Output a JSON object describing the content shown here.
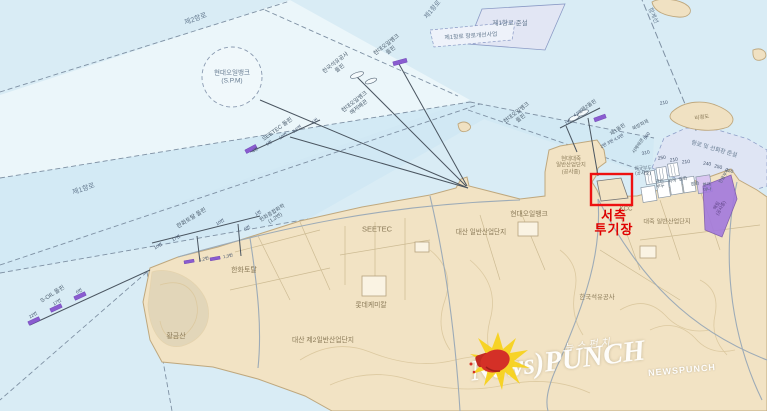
{
  "map": {
    "labels": [
      {
        "t": "제2항로",
        "x": 196,
        "y": 20,
        "r": -20,
        "s": 7,
        "c": "w"
      },
      {
        "t": "제1항로",
        "x": 433,
        "y": 10,
        "r": -50,
        "s": 6.5,
        "c": "w"
      },
      {
        "t": "제1항로 준설",
        "x": 510,
        "y": 24,
        "r": 0,
        "s": 6.5,
        "c": "w"
      },
      {
        "t": "제1항로 항로개선사업",
        "x": 471,
        "y": 37,
        "r": -4,
        "s": 5.8,
        "c": "w"
      },
      {
        "t": "항계선",
        "x": 652,
        "y": 16,
        "r": 66,
        "s": 6,
        "c": "w"
      },
      {
        "t": "현대오일뱅크\n(S.P.M)",
        "x": 232,
        "y": 77,
        "r": 0,
        "s": 6.5,
        "c": "w"
      },
      {
        "t": "제1항로",
        "x": 84,
        "y": 190,
        "r": -19,
        "s": 7,
        "c": "w"
      },
      {
        "t": "한국석유공사\n돌핀",
        "x": 338,
        "y": 66,
        "r": -38,
        "s": 5.6,
        "c": "d"
      },
      {
        "t": "현대오일뱅크\n돌핀",
        "x": 389,
        "y": 48,
        "r": -38,
        "s": 5.6,
        "c": "d"
      },
      {
        "t": "현대오일뱅크\n해저배관",
        "x": 357,
        "y": 105,
        "r": -38,
        "s": 5.6,
        "c": "d"
      },
      {
        "t": "SEETEC 돌핀",
        "x": 278,
        "y": 130,
        "r": -36,
        "s": 5.8,
        "c": "d"
      },
      {
        "t": "1번",
        "x": 315,
        "y": 121,
        "r": -36,
        "s": 4.4,
        "c": "n"
      },
      {
        "t": "5,6번",
        "x": 297,
        "y": 129,
        "r": -36,
        "s": 4.4,
        "c": "n"
      },
      {
        "t": "10번",
        "x": 283,
        "y": 136,
        "r": -36,
        "s": 4.4,
        "c": "n"
      },
      {
        "t": "1번",
        "x": 269,
        "y": 143,
        "r": -36,
        "s": 4.4,
        "c": "n"
      },
      {
        "t": "4번",
        "x": 255,
        "y": 150,
        "r": -36,
        "s": 4.4,
        "c": "n"
      },
      {
        "t": "현대오일뱅크\n돌핀",
        "x": 519,
        "y": 116,
        "r": -38,
        "s": 5.6,
        "c": "d"
      },
      {
        "t": "제2돌핀",
        "x": 589,
        "y": 106,
        "r": -34,
        "s": 5.2,
        "c": "d"
      },
      {
        "t": "4,5번",
        "x": 578,
        "y": 113,
        "r": -34,
        "s": 4.4,
        "c": "n"
      },
      {
        "t": "1번",
        "x": 568,
        "y": 122,
        "r": -34,
        "s": 4.4,
        "c": "n"
      },
      {
        "t": "제1돌핀",
        "x": 618,
        "y": 130,
        "r": -34,
        "s": 5.2,
        "c": "d"
      },
      {
        "t": "2번 3번 4,5번",
        "x": 612,
        "y": 141,
        "r": -28,
        "s": 4.4,
        "c": "n"
      },
      {
        "t": "서해배관",
        "x": 638,
        "y": 146,
        "r": -56,
        "s": 4.6,
        "c": "d"
      },
      {
        "t": "560",
        "x": 647,
        "y": 136,
        "r": -56,
        "s": 4.6,
        "c": "n"
      },
      {
        "t": "북방파제",
        "x": 641,
        "y": 126,
        "r": -28,
        "s": 4.8,
        "c": "d"
      },
      {
        "t": "210",
        "x": 664,
        "y": 104,
        "r": -10,
        "s": 4.8,
        "c": "n"
      },
      {
        "t": "비경도",
        "x": 702,
        "y": 118,
        "r": -8,
        "s": 5.4,
        "c": "l"
      },
      {
        "t": "한화토탈 돌핀",
        "x": 192,
        "y": 219,
        "r": -32,
        "s": 5.8,
        "c": "d"
      },
      {
        "t": "10번",
        "x": 220,
        "y": 222,
        "r": -32,
        "s": 4.4,
        "c": "n"
      },
      {
        "t": "1번",
        "x": 258,
        "y": 213,
        "r": -32,
        "s": 4.4,
        "c": "n"
      },
      {
        "t": "6번",
        "x": 247,
        "y": 228,
        "r": -32,
        "s": 4.4,
        "c": "n"
      },
      {
        "t": "17번",
        "x": 176,
        "y": 238,
        "r": -32,
        "s": 4.4,
        "c": "n"
      },
      {
        "t": "10번",
        "x": 158,
        "y": 246,
        "r": -32,
        "s": 4.4,
        "c": "n"
      },
      {
        "t": "1,2번",
        "x": 204,
        "y": 259,
        "r": -12,
        "s": 4.4,
        "c": "n"
      },
      {
        "t": "1,3번",
        "x": 228,
        "y": 256,
        "r": -12,
        "s": 4.4,
        "c": "n"
      },
      {
        "t": "한화종합화학\n(1,2번)",
        "x": 274,
        "y": 216,
        "r": -32,
        "s": 5.2,
        "c": "d"
      },
      {
        "t": "S-OIL 돌핀",
        "x": 53,
        "y": 295,
        "r": -32,
        "s": 5.8,
        "c": "d"
      },
      {
        "t": "6번",
        "x": 79,
        "y": 291,
        "r": -32,
        "s": 4.4,
        "c": "n"
      },
      {
        "t": "17번",
        "x": 57,
        "y": 302,
        "r": -32,
        "s": 4.4,
        "c": "n"
      },
      {
        "t": "22번",
        "x": 33,
        "y": 315,
        "r": -32,
        "s": 4.4,
        "c": "n"
      },
      {
        "t": "황금산",
        "x": 176,
        "y": 337,
        "r": 0,
        "s": 7,
        "c": "l"
      },
      {
        "t": "한화토탈",
        "x": 244,
        "y": 271,
        "r": 0,
        "s": 7,
        "c": "l"
      },
      {
        "t": "대산 제2일반산업단지",
        "x": 323,
        "y": 341,
        "r": 0,
        "s": 6.8,
        "c": "l"
      },
      {
        "t": "롯데케미칼",
        "x": 371,
        "y": 306,
        "r": 0,
        "s": 6.8,
        "c": "l"
      },
      {
        "t": "SEETEC",
        "x": 377,
        "y": 230,
        "r": 0,
        "s": 7.5,
        "c": "l"
      },
      {
        "t": "대산 일반산업단지",
        "x": 481,
        "y": 233,
        "r": 0,
        "s": 6.6,
        "c": "l"
      },
      {
        "t": "현대오일뱅크",
        "x": 529,
        "y": 215,
        "r": 0,
        "s": 6.8,
        "c": "l"
      },
      {
        "t": "KCC",
        "x": 626,
        "y": 209,
        "r": 0,
        "s": 6.2,
        "c": "l"
      },
      {
        "t": "대죽 일반산업단지",
        "x": 667,
        "y": 222,
        "r": 0,
        "s": 6.2,
        "c": "l"
      },
      {
        "t": "한국석유공사",
        "x": 597,
        "y": 298,
        "r": 0,
        "s": 6.4,
        "c": "l"
      },
      {
        "t": "현대대죽\n일반산업단지\n(공사중)",
        "x": 571,
        "y": 166,
        "r": 0,
        "s": 5.4,
        "c": "l"
      },
      {
        "t": "신규부두\n(공사중)",
        "x": 643,
        "y": 171,
        "r": 0,
        "s": 4.6,
        "c": "d"
      },
      {
        "t": "관리\n부두",
        "x": 660,
        "y": 184,
        "r": -8,
        "s": 4.6,
        "c": "d"
      },
      {
        "t": "여객",
        "x": 672,
        "y": 181,
        "r": -8,
        "s": 4.6,
        "c": "d"
      },
      {
        "t": "잡화",
        "x": 683,
        "y": 179,
        "r": -8,
        "s": 4.6,
        "c": "d"
      },
      {
        "t": "잡화",
        "x": 695,
        "y": 184,
        "r": -8,
        "s": 4.6,
        "c": "d"
      },
      {
        "t": "현대\n미나",
        "x": 707,
        "y": 187,
        "r": -8,
        "s": 4.4,
        "c": "d"
      },
      {
        "t": "전용부두",
        "x": 724,
        "y": 176,
        "r": -60,
        "s": 4.4,
        "c": "d"
      },
      {
        "t": "매립\n(공사중)",
        "x": 719,
        "y": 207,
        "r": -60,
        "s": 4.6,
        "c": "pu"
      },
      {
        "t": "항로 및 선회장 준설",
        "x": 714,
        "y": 150,
        "r": 16,
        "s": 5.8,
        "c": "w"
      },
      {
        "t": "310",
        "x": 646,
        "y": 154,
        "r": -14,
        "s": 4.8,
        "c": "n"
      },
      {
        "t": "250",
        "x": 662,
        "y": 159,
        "r": -10,
        "s": 4.8,
        "c": "n"
      },
      {
        "t": "210",
        "x": 674,
        "y": 161,
        "r": -8,
        "s": 4.8,
        "c": "n"
      },
      {
        "t": "210",
        "x": 686,
        "y": 163,
        "r": -4,
        "s": 4.8,
        "c": "n"
      },
      {
        "t": "240",
        "x": 707,
        "y": 165,
        "r": 8,
        "s": 4.8,
        "c": "n"
      },
      {
        "t": "250",
        "x": 718,
        "y": 168,
        "r": 12,
        "s": 4.8,
        "c": "n"
      },
      {
        "t": "250",
        "x": 729,
        "y": 172,
        "r": 16,
        "s": 4.8,
        "c": "n"
      }
    ],
    "highlight": {
      "line1": "서측",
      "line2": "투기장"
    },
    "colors": {
      "water": "#d9ecf5",
      "pale_channel": "#ebf6fa",
      "channel": "#cfe8f3",
      "dredge_zone": "#e0e5f4",
      "land": "#f2e3c4",
      "land_stroke": "#bfa87e",
      "reclaim_purple": "#a379dd",
      "dolphin_purple": "#8a5cd0",
      "highlight_red": "#ee1111",
      "watermark_white": "#ffffff",
      "glove_red": "#d43027",
      "starburst_yellow": "#f7d21e"
    }
  },
  "watermark": {
    "korean": "뉴스펀치",
    "logo": "News)PUNCH",
    "small": "NEWSPUNCH"
  }
}
